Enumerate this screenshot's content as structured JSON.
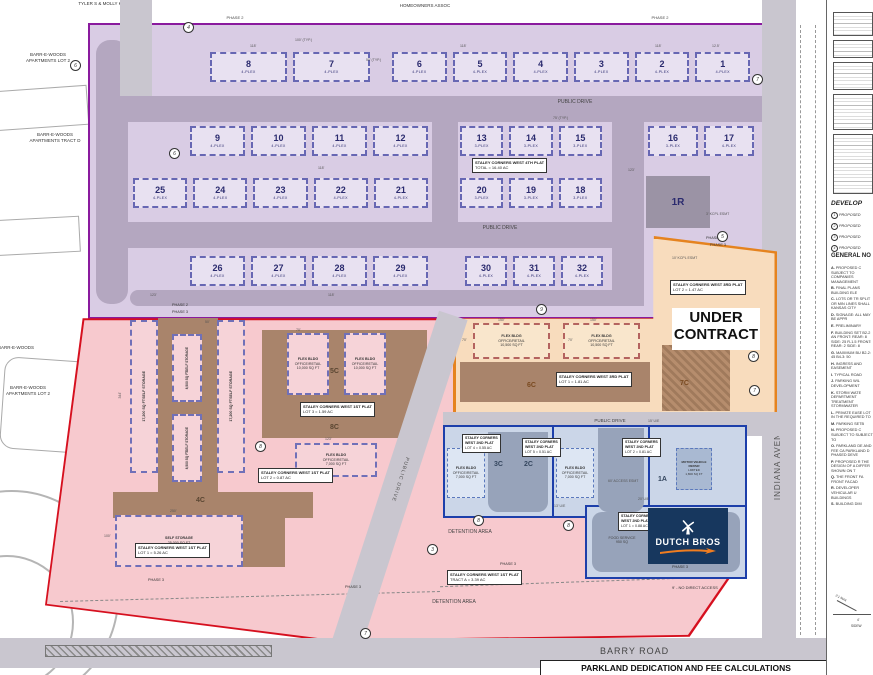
{
  "surroundings": {
    "tyler": "TYLER S & MOLLY K",
    "barr_lot2_top": "BARR-E-WOODS APARTMENTS LOT 2",
    "barr_tract_d": "BARR-E-WOODS APARTMENTS TRACT D",
    "barr_woods": "BARR-E-WOODS",
    "barr_lot2_low": "BARR-E-WOODS APARTMENTS LOT 2",
    "hoa": "HOMEOWNERS ASSOC"
  },
  "roads": {
    "public_drive": "PUBLIC DRIVE",
    "indiana": "INDIANA AVENUE",
    "barry": "BARRY ROAD"
  },
  "phase2": {
    "phase_label": "PHASE 2",
    "buffer_top": "30' WIDE LANDSCAPE BUFFER",
    "buffer_right": "30' BUFFER",
    "buffer_bottom": "30' WIDE LANDSCAPE BUFFER",
    "detention": "DETENTION AREA",
    "plat4_l1": "STALEY CORNERS WEST 4TH PLAT",
    "plat4_l2": "TOTAL = 16.40 AC",
    "lot_1r": "1R",
    "rows": {
      "r1l": [
        {
          "n": "8",
          "t": "4-PLEX"
        },
        {
          "n": "7",
          "t": "4-PLEX"
        }
      ],
      "r1r": [
        {
          "n": "6",
          "t": "4-PLEX"
        },
        {
          "n": "5",
          "t": "4-PLEX"
        },
        {
          "n": "4",
          "t": "4-PLEX"
        },
        {
          "n": "3",
          "t": "4-PLEX"
        },
        {
          "n": "2",
          "t": "4-PLEX"
        },
        {
          "n": "1",
          "t": "4-PLEX"
        }
      ],
      "r2l": [
        {
          "n": "9",
          "t": "4-PLEX"
        },
        {
          "n": "10",
          "t": "4-PLEX"
        },
        {
          "n": "11",
          "t": "4-PLEX"
        },
        {
          "n": "12",
          "t": "4-PLEX"
        }
      ],
      "r2r": [
        {
          "n": "13",
          "t": "3-PLEX"
        },
        {
          "n": "14",
          "t": "3-PLEX"
        },
        {
          "n": "15",
          "t": "3-PLEX"
        }
      ],
      "r2f": [
        {
          "n": "16",
          "t": "3-PLEX"
        },
        {
          "n": "17",
          "t": "4-PLEX"
        }
      ],
      "r3l": [
        {
          "n": "25",
          "t": "4-PLEX"
        },
        {
          "n": "24",
          "t": "4-PLEX"
        },
        {
          "n": "23",
          "t": "4-PLEX"
        },
        {
          "n": "22",
          "t": "4-PLEX"
        },
        {
          "n": "21",
          "t": "4-PLEX"
        }
      ],
      "r3r": [
        {
          "n": "20",
          "t": "3-PLEX"
        },
        {
          "n": "19",
          "t": "3-PLEX"
        },
        {
          "n": "18",
          "t": "3-PLEX"
        }
      ],
      "r4l": [
        {
          "n": "26",
          "t": "4-PLEX"
        },
        {
          "n": "27",
          "t": "4-PLEX"
        },
        {
          "n": "28",
          "t": "4-PLEX"
        },
        {
          "n": "29",
          "t": "4-PLEX"
        }
      ],
      "r4r": [
        {
          "n": "30",
          "t": "4-PLEX"
        },
        {
          "n": "31",
          "t": "4-PLEX"
        },
        {
          "n": "32",
          "t": "4-PLEX"
        }
      ]
    }
  },
  "pink": {
    "phase_label": "PHASE 3",
    "storage_name": "SELF STORAGE",
    "storage_17200": "17,200 SQ FT",
    "storage_8500": "8,500 SQ FT",
    "storage_25000": "25,000 SQ FT",
    "label_4c": "4C",
    "label_5c": "5C",
    "label_8c": "8C",
    "flex10k_l1": "FLEX BLDG",
    "flex10k_l2": "OFFICE/RETAIL",
    "flex10k_l3": "10,000 SQ FT",
    "flex7k_l1": "FLEX BLDG",
    "flex7k_l2": "OFFICE/RETAIL",
    "flex7k_l3": "7,000 SQ FT",
    "plat1": "STALEY CORNERS WEST 1ST PLAT",
    "plat1_lot3": "LOT 3 = 1.59 AC",
    "plat1_lot2": "LOT 2 = 0.87 AC",
    "plat1_lot1": "LOT 1 = 5.26 AC",
    "plat1_tract": "TRACT A = 3.39 AC",
    "detention": "DETENTION AREA"
  },
  "orange": {
    "under_l1": "UNDER",
    "under_l2": "CONTRACT",
    "plat3": "STALEY CORNERS WEST 3RD PLAT",
    "plat3_lot2": "LOT 2 = 1.47 AC",
    "plat3_lot1": "LOT 1 = 1.81 AC",
    "flex105_l1": "FLEX BLDG",
    "flex105_l2": "OFFICE/RETAIL",
    "flex105_l3": "10,500 SQ FT",
    "label_6c": "6C",
    "label_7c": "7C",
    "phase2": "PHASE 2",
    "phase3": "PHASE 3"
  },
  "blue": {
    "plat2_l1": "STALEY CORNERS",
    "plat2_l2": "WEST 2ND PLAT",
    "lot4": "LOT 4 = 0.55 AC",
    "lot5": "LOT 5 = 0.51 AC",
    "lot2": "LOT 2 = 0.81 AC",
    "lot1": "LOT 1 = 0.88 AC",
    "flex7k_l1": "FLEX BLDG",
    "flex7k_l2": "OFFICE/RETAIL",
    "flex7k_l3": "7,000 SQ FT",
    "motor_l1": "MOTOR VEHICLE REPAIR",
    "motor_l2": "LIMITED",
    "motor_l3": "1,800 SQ FT",
    "label_3c": "3C",
    "label_2c": "2C",
    "label_1a": "1A",
    "food_l1": "FOOD SERVICE",
    "food_l2": "950 SQ",
    "phase3": "PHASE 3"
  },
  "dutch": {
    "brand": "DUTCH BROS"
  },
  "dims": [
    "118'",
    "100' (TYP.)",
    "50' (TYP.)",
    "12.5'",
    "118'",
    "118'",
    "118'",
    "75' (TYP.)",
    "123'",
    "118'",
    "123'",
    "150'",
    "70'",
    "150'",
    "344'",
    "250'",
    "100'",
    "123'",
    "15' U/E",
    "20' U/E",
    "13' U/E",
    "10' KCPL ESMT",
    "3' KCPL ESMT",
    "60' ACCESS ESMT",
    "9' - NO DIRECT ACCESS",
    "50'",
    "70'",
    "70'"
  ],
  "keynotes": [
    "4",
    "6",
    "7",
    "5",
    "9",
    "8",
    "8",
    "3",
    "8",
    "7",
    "6",
    "8",
    "7"
  ],
  "boundary": {
    "phase2": "PHASE 2",
    "phase3": "PHASE 3"
  },
  "bottom": {
    "parkland": "PARKLAND DEDICATION AND FEE CALCULATIONS"
  },
  "sidebar": {
    "dev_heading": "DEVELOP",
    "dev_items": [
      {
        "n": "1",
        "t": "PROPOSED"
      },
      {
        "n": "2",
        "t": "PROPOSED"
      },
      {
        "n": "3",
        "t": "PROPOSED"
      },
      {
        "n": "4",
        "t": "PROPOSED"
      }
    ],
    "gen_heading": "GENERAL NO",
    "notes": [
      {
        "k": "A.",
        "t": "PROPOSED C SUBJECT TO COMPANIES MANAGEMENT"
      },
      {
        "k": "B.",
        "t": "FINAL PLANS BUILDING ELE"
      },
      {
        "k": "C.",
        "t": "LOTS OR TR SPLIT OR MIN LINES SHALL KANSAS CITY"
      },
      {
        "k": "D.",
        "t": "SIGNAGE: ALL MAY BE APPR"
      },
      {
        "k": "E.",
        "t": "PRELIMINARY"
      },
      {
        "k": "F.",
        "t": "BUILDING SET B2-2 AN FRONT: REAR: 8 SIDE: 25 R-1.5 FRONT: REAR: 2 SIDE: 8"
      },
      {
        "k": "G.",
        "t": "MAXIMUM BU B2-2: 45 B4-3: 50"
      },
      {
        "k": "H.",
        "t": "INGRESS AND EASEMENT"
      },
      {
        "k": "I.",
        "t": "TYPICAL ROAD"
      },
      {
        "k": "J.",
        "t": "PARKING WIL DEVELOPMENT"
      },
      {
        "k": "K.",
        "t": "STORM WATE DEPARTMENT TREATMENT STORMWATER"
      },
      {
        "k": "L.",
        "t": "PRIVATE EASE LOT IN THE REQUIRED TO"
      },
      {
        "k": "M.",
        "t": "PARKING SETB"
      },
      {
        "k": "N.",
        "t": "PROPOSED C SUBJECT TO SUBJECT TO"
      },
      {
        "k": "O.",
        "t": "PARKLAND DE AND FEE CA PARKLAND D PHASED DEVE"
      },
      {
        "k": "P.",
        "t": "PROPOSED R THE DESIGN OF A DIFFER SHOWN ON T"
      },
      {
        "k": "Q.",
        "t": "THE FRONT FA FRONT FACAD"
      },
      {
        "k": "R.",
        "t": "DEVELOPER VEHICULAR U BUILDINGS"
      },
      {
        "k": "S.",
        "t": "BUILDING DIM"
      }
    ],
    "detail_slope": "2:1 MAX",
    "detail_w": "4'",
    "detail_sw": "SIDEW"
  }
}
